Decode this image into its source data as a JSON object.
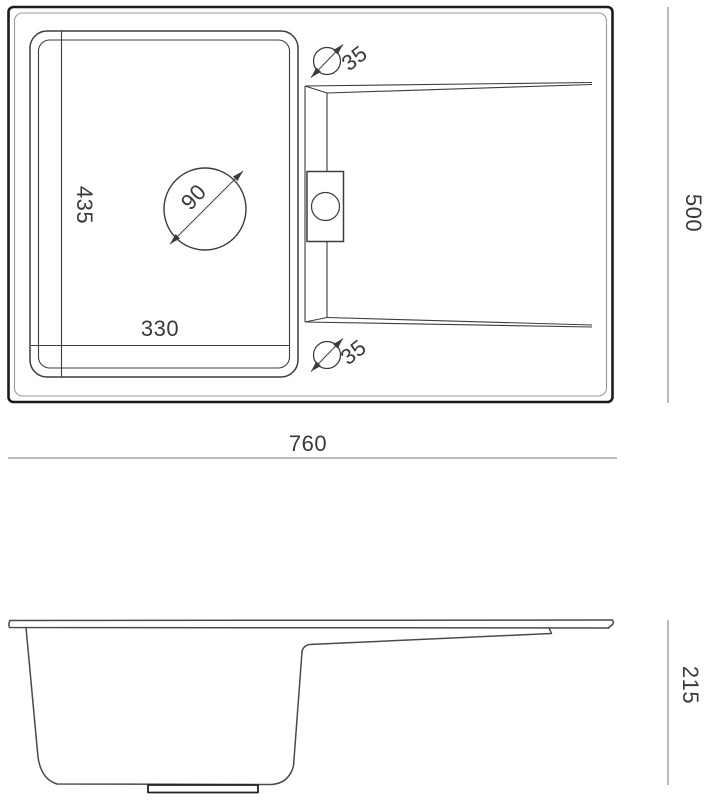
{
  "drawing": {
    "type": "sink-technical-drawing",
    "line_colors": {
      "outer_frame": "#1c1c1c",
      "inner_frame": "#9a9a9a",
      "feature_lines": "#3c3c3c",
      "dimension_lines": "#777777",
      "text": "#3a3a3a"
    },
    "top_view": {
      "overall_width": "760",
      "overall_depth": "500",
      "basin_inner_width": "330",
      "basin_inner_depth": "435",
      "drain_diameter": "90",
      "tap_hole_top_diameter": "35",
      "tap_hole_bottom_diameter": "35"
    },
    "side_view": {
      "overall_height": "215"
    }
  }
}
